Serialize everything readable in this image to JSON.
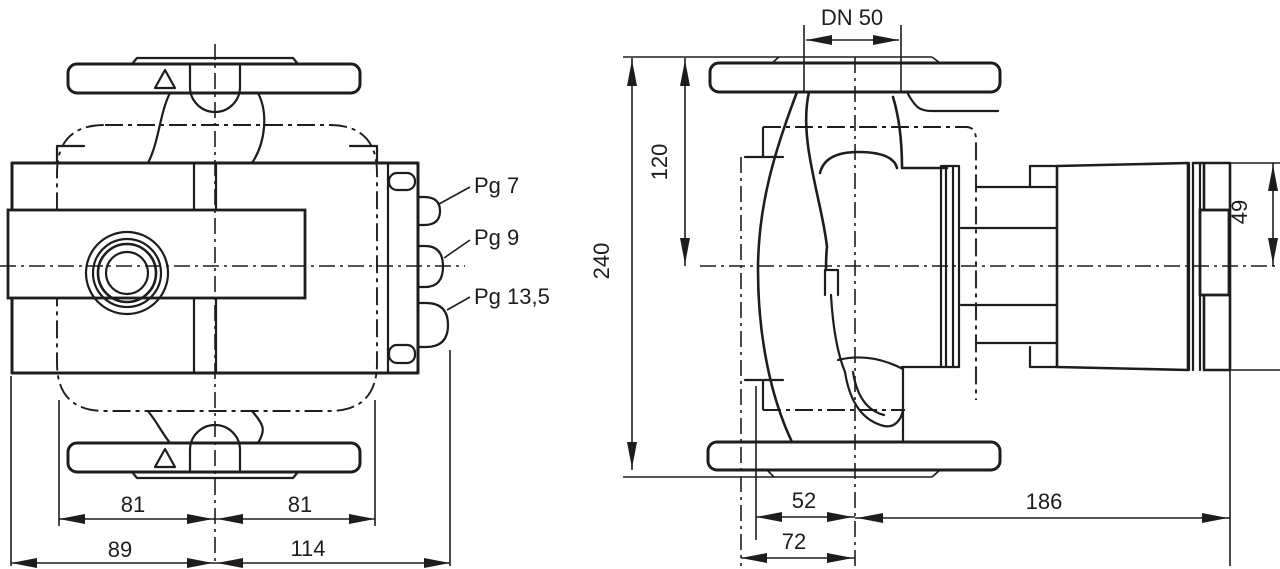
{
  "drawing": {
    "title": "pump-dimensional-drawing",
    "colors": {
      "background": "#ffffff",
      "line": "#1d1d1b"
    },
    "front_view": {
      "gland_labels": {
        "pg7": "Pg 7",
        "pg9": "Pg 9",
        "pg135": "Pg 13,5"
      },
      "dims": {
        "half_width_left": "81",
        "half_width_right": "81",
        "base_left": "89",
        "base_right": "114"
      }
    },
    "side_view": {
      "dims": {
        "flange": "DN 50",
        "upper_height": "120",
        "total_height": "240",
        "terminal_box_height": "49",
        "front_depth": "52",
        "base_depth": "72",
        "rear_depth": "186"
      }
    }
  }
}
